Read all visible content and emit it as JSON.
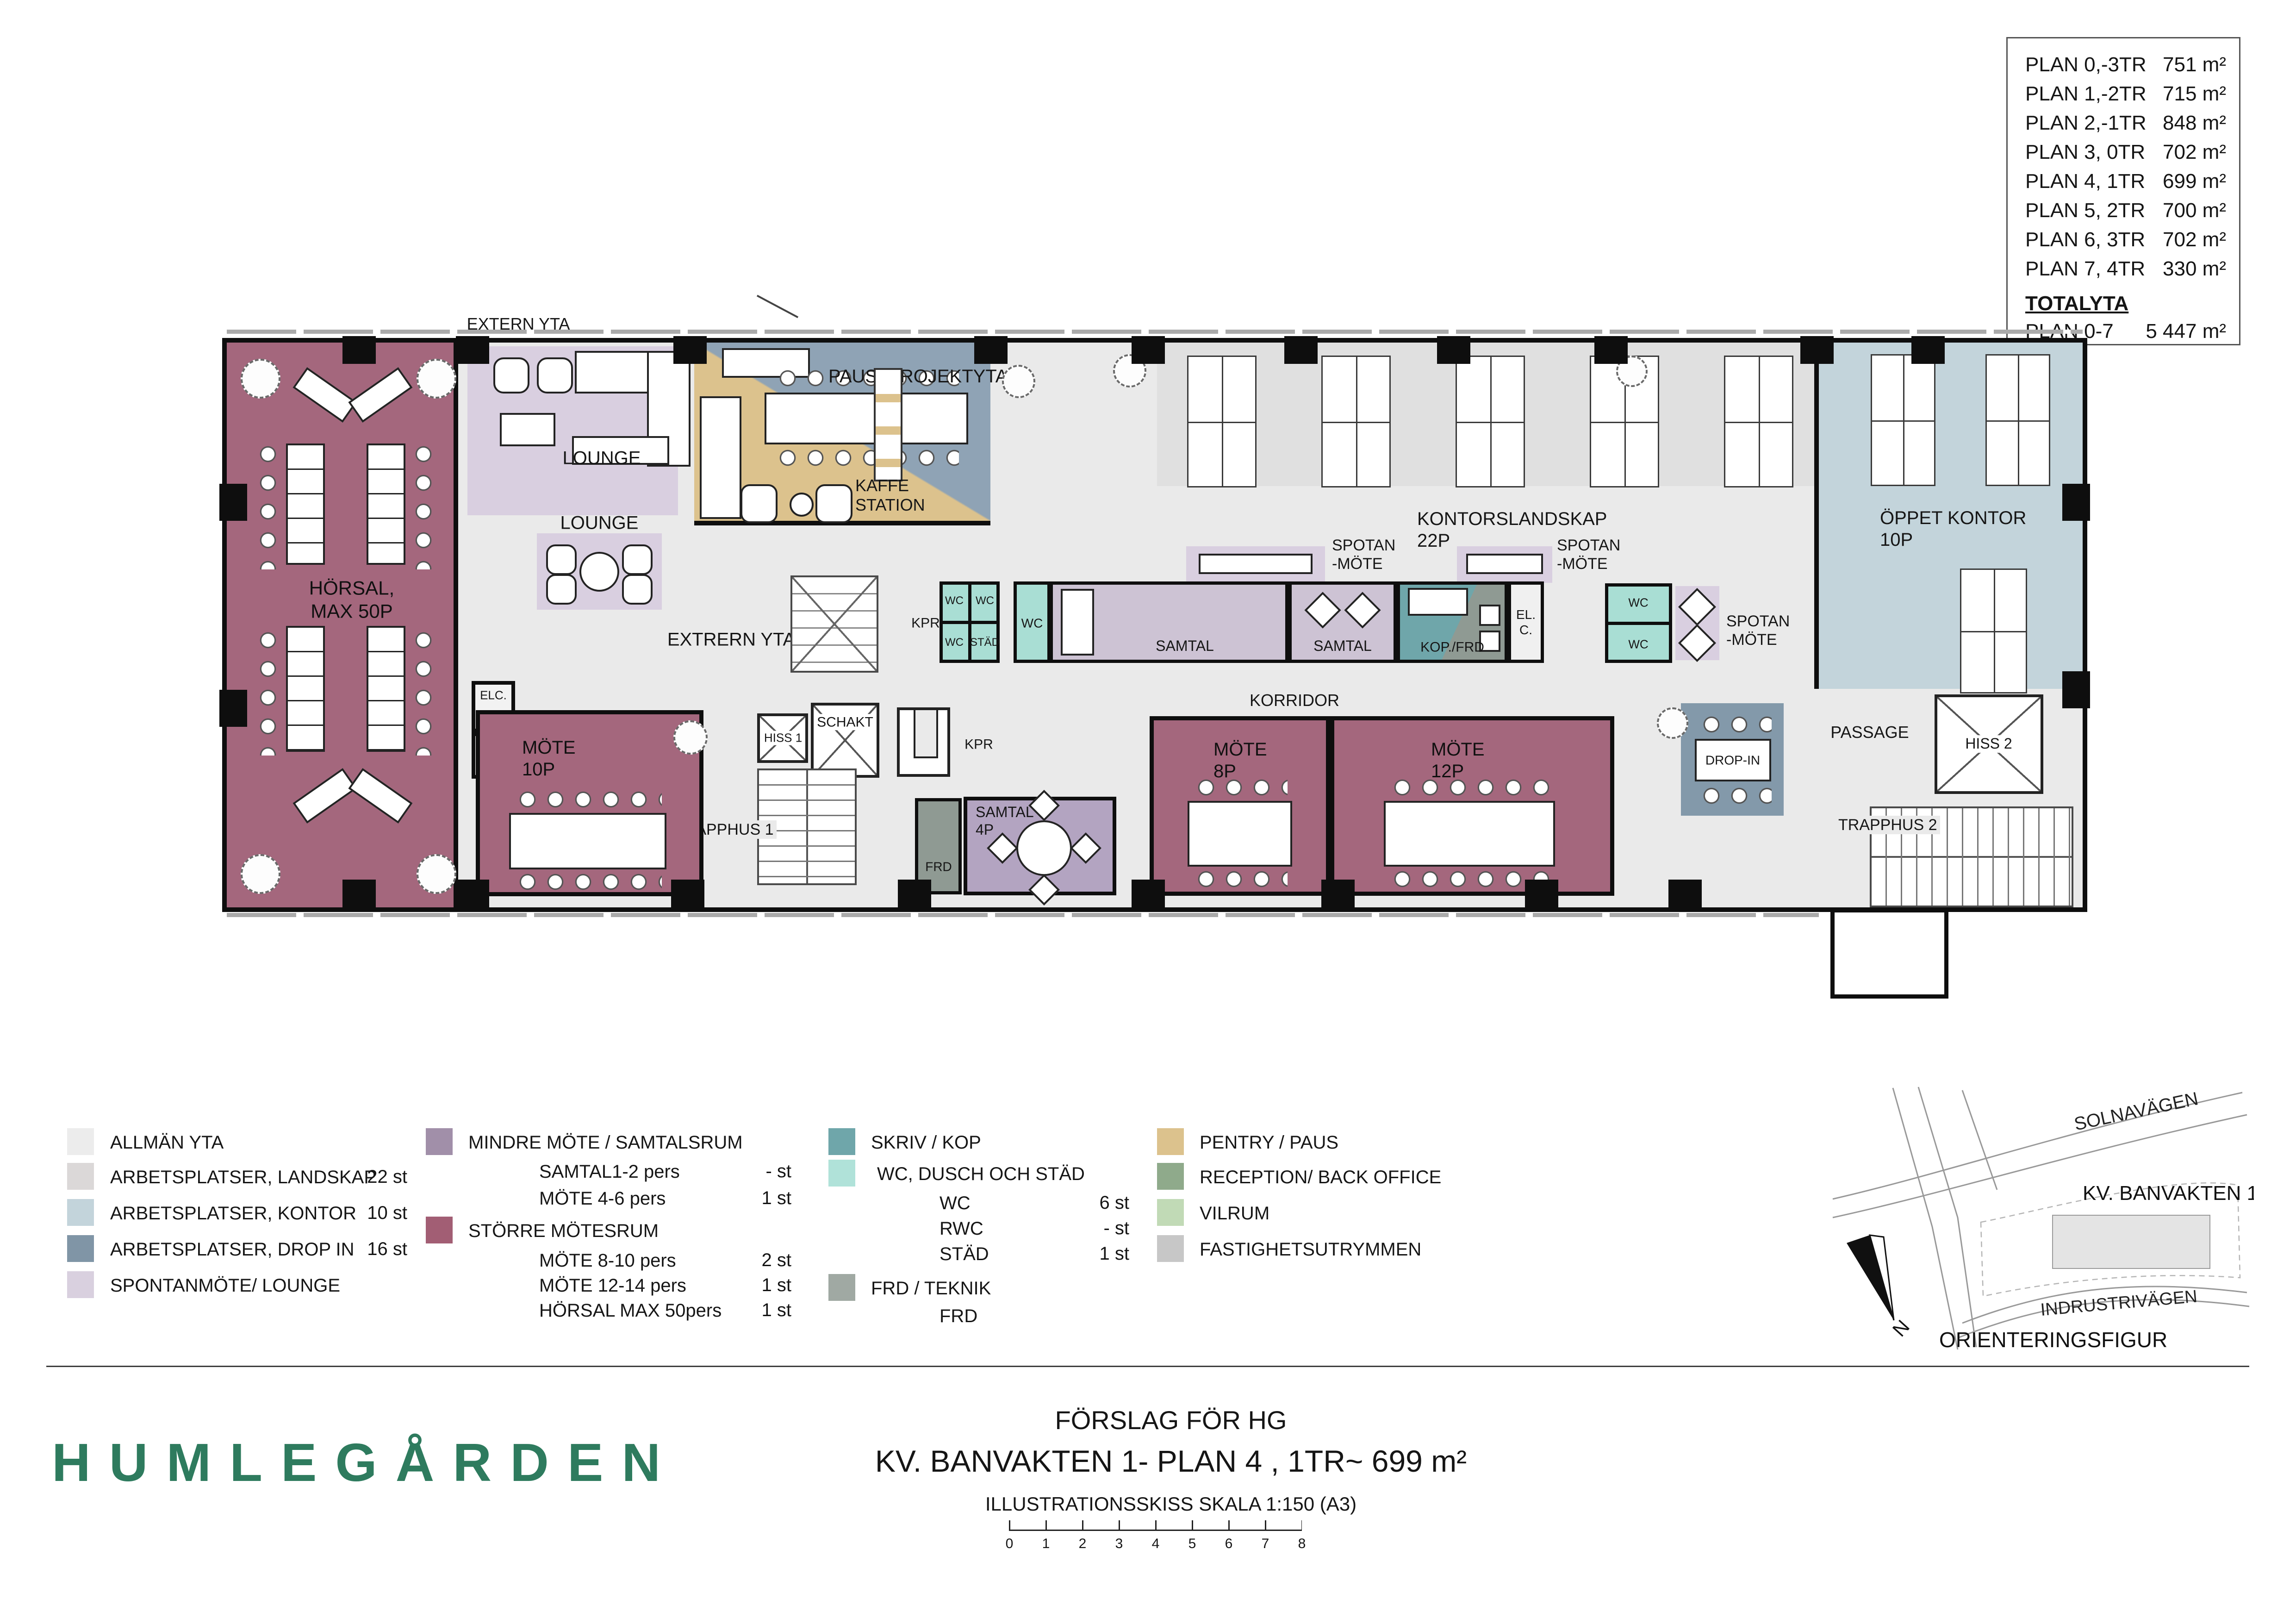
{
  "doc": {
    "logo": "HUMLEGÅRDEN",
    "title1": "FÖRSLAG FÖR HG",
    "title2": "KV. BANVAKTEN 1- PLAN 4 , 1TR~ 699 m²",
    "title3": "ILLUSTRATIONSSKISS SKALA 1:150 (A3)",
    "scale_numbers": [
      "0",
      "1",
      "2",
      "3",
      "4",
      "5",
      "6",
      "7",
      "8"
    ]
  },
  "area_table": {
    "rows": [
      {
        "label": "PLAN 0,-3TR",
        "value": "751 m²"
      },
      {
        "label": "PLAN 1,-2TR",
        "value": "715 m²"
      },
      {
        "label": "PLAN 2,-1TR",
        "value": "848 m²"
      },
      {
        "label": "PLAN 3, 0TR",
        "value": "702 m²"
      },
      {
        "label": "PLAN 4, 1TR",
        "value": "699 m²"
      },
      {
        "label": "PLAN 5, 2TR",
        "value": "700 m²"
      },
      {
        "label": "PLAN 6, 3TR",
        "value": "702 m²"
      },
      {
        "label": "PLAN 7, 4TR",
        "value": "330 m²"
      }
    ],
    "total_label": "TOTALYTA",
    "total_row": {
      "label": "PLAN 0-7",
      "value": "5 447 m²"
    }
  },
  "legend": {
    "col1": [
      {
        "label": "ALLMÄN YTA",
        "count": "",
        "color": "#ECECEC"
      },
      {
        "label": "ARBETSPLATSER, LANDSKAP",
        "count": "22 st",
        "color": "#DBD8D8"
      },
      {
        "label": "ARBETSPLATSER, KONTOR",
        "count": "10 st",
        "color": "#C3D4DB"
      },
      {
        "label": "ARBETSPLATSER, DROP IN",
        "count": "16 st",
        "color": "#8095A6"
      },
      {
        "label": "SPONTANMÖTE/ LOUNGE",
        "count": "",
        "color": "#D9D0DF"
      }
    ],
    "col2_group1": {
      "label": "MINDRE MÖTE / SAMTALSRUM",
      "color": "#A18FA9"
    },
    "col2_group1_items": [
      {
        "label": "SAMTAL1-2 pers",
        "count": "- st"
      },
      {
        "label": "MÖTE 4-6 pers",
        "count": "1 st"
      }
    ],
    "col2_group2": {
      "label": "STÖRRE MÖTESRUM",
      "color": "#A25E74"
    },
    "col2_group2_items": [
      {
        "label": "MÖTE 8-10 pers",
        "count": "2 st"
      },
      {
        "label": "MÖTE 12-14 pers",
        "count": "1 st"
      },
      {
        "label": "HÖRSAL MAX 50pers",
        "count": "1 st"
      }
    ],
    "col3_skriv": {
      "label": "SKRIV / KOP",
      "color": "#6FA6AA"
    },
    "col3_wc": {
      "label": "WC, DUSCH OCH STÄD",
      "color": "#B0E2D9"
    },
    "col3_wc_items": [
      {
        "label": "WC",
        "count": "6 st"
      },
      {
        "label": "RWC",
        "count": "- st"
      },
      {
        "label": "STÄD",
        "count": "1 st"
      }
    ],
    "col3_frd": {
      "label": "FRD / TEKNIK",
      "color": "#A0A9A3"
    },
    "col3_frd_items": [
      {
        "label": "FRD",
        "count": ""
      }
    ],
    "col4": [
      {
        "label": "PENTRY / PAUS",
        "color": "#DCC28D"
      },
      {
        "label": "RECEPTION/ BACK OFFICE",
        "color": "#8FAA8B"
      },
      {
        "label": "VILRUM",
        "count": "",
        "color": "#C1DAB6"
      },
      {
        "label": "FASTIGHETSUTRYMMEN",
        "color": "#C7C7C7"
      }
    ]
  },
  "orientation": {
    "road1": "SOLNAVÄGEN",
    "road2": "INDRUSTRIVÄGEN",
    "block": "KV. BANVAKTEN 1",
    "caption": "ORIENTERINGSFIGUR",
    "north": "N"
  },
  "plan": {
    "labels": {
      "extern": "EXTERN YTA",
      "extrern": "EXTRERN YTA",
      "horsal": "HÖRSAL,\nMAX 50P",
      "lounge": "LOUNGE",
      "paus": "PAUS/ PROJEKTYTA",
      "kaffe": "KAFFE\nSTATION",
      "kontorslandskap": "KONTORSLANDSKAP\n22P",
      "spotan": "SPOTAN\n-MÖTE",
      "oppet": "ÖPPET KONTOR\n10P",
      "kpr": "KPR",
      "wc": "WC",
      "stad": "STÄD",
      "samtal": "SAMTAL",
      "kopfrd": "KOP./FRD",
      "el_c": "EL.\nC.",
      "elc": "ELC.",
      "korridor": "KORRIDOR",
      "mote10": "MÖTE\n10P",
      "frd": "FRD",
      "samtal4": "SAMTAL\n4P",
      "mote8": "MÖTE\n8P",
      "mote12": "MÖTE\n12P",
      "dropin": "DROP-IN",
      "passage": "PASSAGE",
      "hiss1": "HISS 1",
      "hiss2": "HISS 2",
      "schakt": "SCHAKT",
      "trapphus1": "TRAPPHUS 1",
      "trapphus2": "TRAPPHUS 2"
    }
  },
  "colors": {
    "floor": "#EAEAEA",
    "landskap_zone": "#E0E0E0",
    "horsal": "#A4677D",
    "lounge_rug": "#D9CFE0",
    "samtal_room": "#CDC3D4",
    "samtal4_room": "#B3A4C1",
    "oppet_kontor": "#C3D4DB",
    "dropin": "#8399AA",
    "wc": "#A9DED4",
    "skriv_kop": "#6FA6AA",
    "frd_teknik": "#8F9A93",
    "pentry": "#DCC28D",
    "paus_blue": "#8FA3B5",
    "logo_green": "#2E7B5E",
    "wall": "#0E0E0E"
  }
}
